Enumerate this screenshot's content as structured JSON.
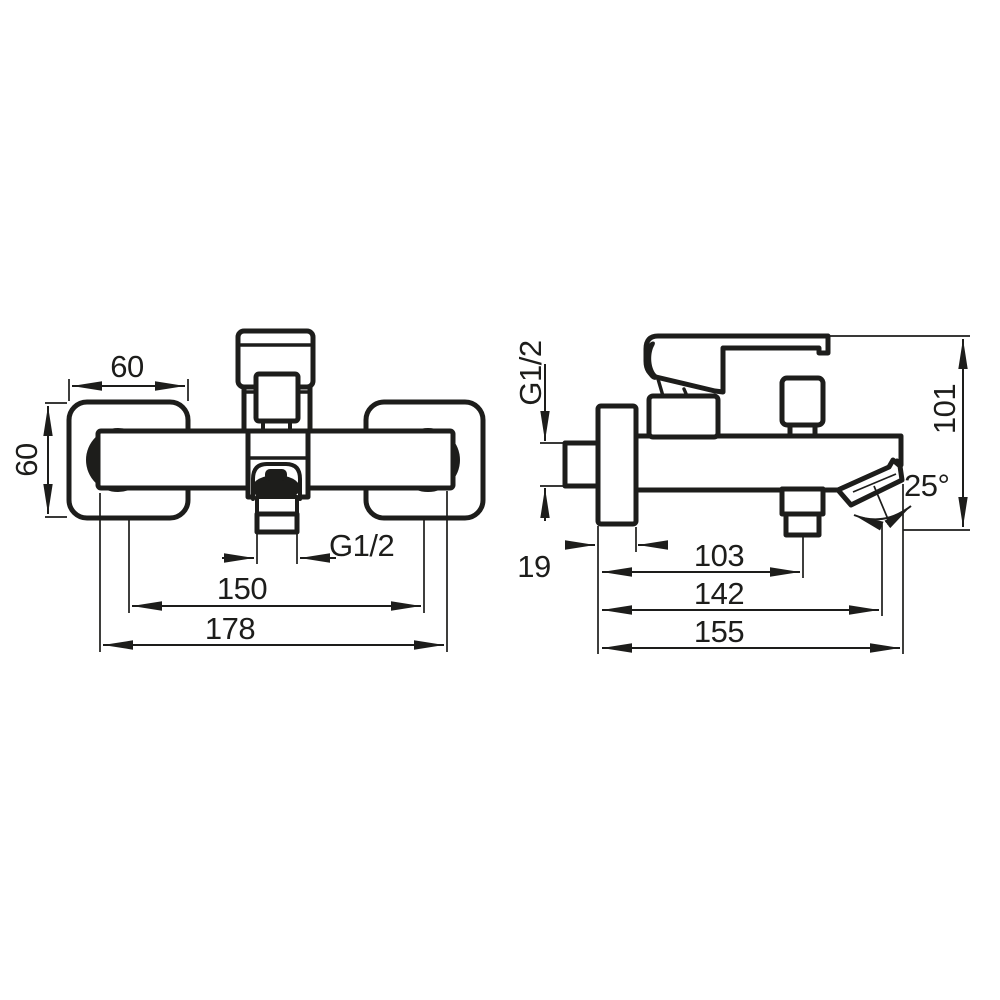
{
  "drawing": {
    "kind": "technical-dimension-drawing",
    "subject": "wall-mounted bath mixer tap, front and side views",
    "colors": {
      "line": "#1d1d1b",
      "background": "#ffffff"
    },
    "front_view": {
      "dims": {
        "plate_width": "60",
        "plate_height": "60",
        "outlet_thread": "G1/2",
        "connection_spacing": "150",
        "overall_width": "178"
      }
    },
    "side_view": {
      "dims": {
        "inlet_thread": "G1/2",
        "plate_depth": "19",
        "shower_outlet_reach": "103",
        "spout_axis_reach": "142",
        "overall_reach": "155",
        "overall_height": "101",
        "spout_angle": "25°"
      }
    }
  }
}
